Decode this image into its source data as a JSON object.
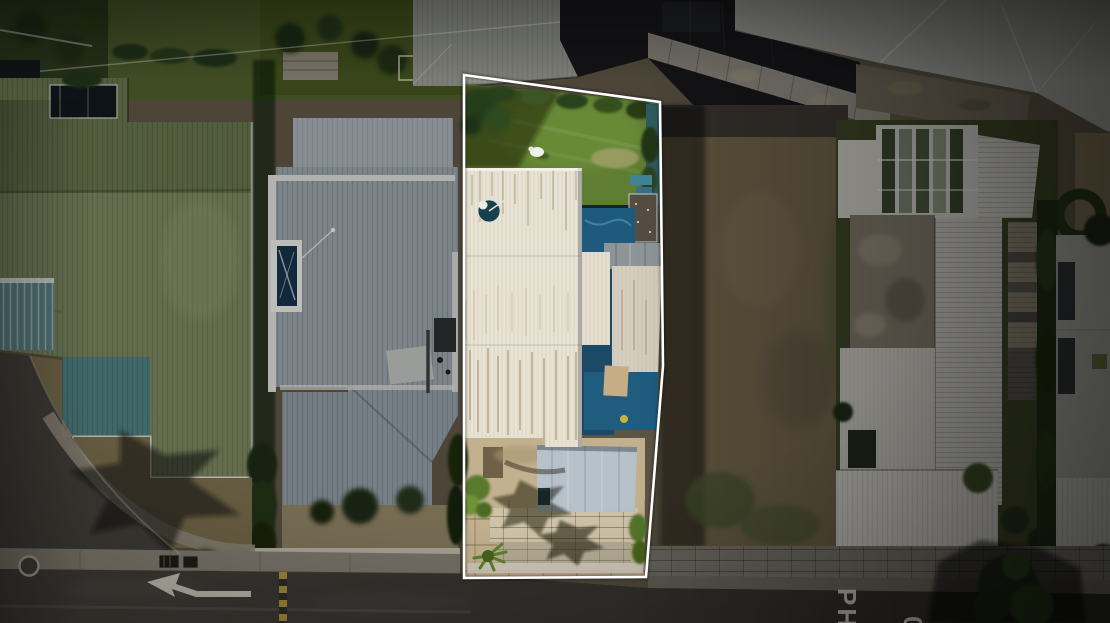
{
  "image": {
    "type": "aerial-drone-photo",
    "subject": "Residential property lot highlighted with a white boundary outline, viewed from directly above, with street at bottom"
  },
  "overlay": {
    "boundary_color": "#ffffff"
  },
  "road_markings": {
    "lane_text_left": "PH",
    "lane_text_right": "20",
    "arrow": "left-turn-arrow"
  },
  "palette": {
    "asphalt": "#46433d",
    "asphalt_shadow": "#2b2926",
    "sidewalk": "#8b8579",
    "stone_wall": "#78746a",
    "green_roof": "#7c8663",
    "teal_roof_patch": "#4f7f80",
    "gray_roof": "#97a0a8",
    "white_roof": "#e8e3d5",
    "lawn": "#5f7e33",
    "pool": "#1f5c7e",
    "solar_panel": "#554c42",
    "carport": "#b6c1c9",
    "driveway": "#c2b08e",
    "dirt_yard": "#6b5f48",
    "right_house_roof": "#c6c5be",
    "hedge": "#26371a"
  }
}
